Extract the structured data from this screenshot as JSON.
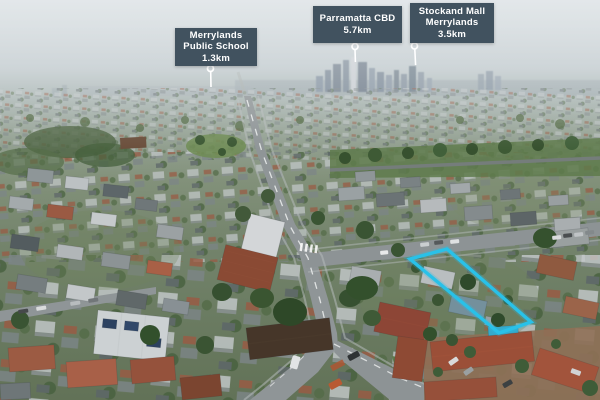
{
  "callouts": {
    "school": {
      "line1": "Merrylands",
      "line2": "Public School",
      "distance": "1.3km"
    },
    "cbd": {
      "line1": "Parramatta CBD",
      "distance": "5.7km"
    },
    "mall": {
      "line1": "Stockand Mall",
      "line2": "Merrylands",
      "distance": "3.5km"
    }
  },
  "colors": {
    "callout_bg": "#41525f",
    "callout_text": "#ffffff",
    "property_highlight": "#29c1e8"
  }
}
